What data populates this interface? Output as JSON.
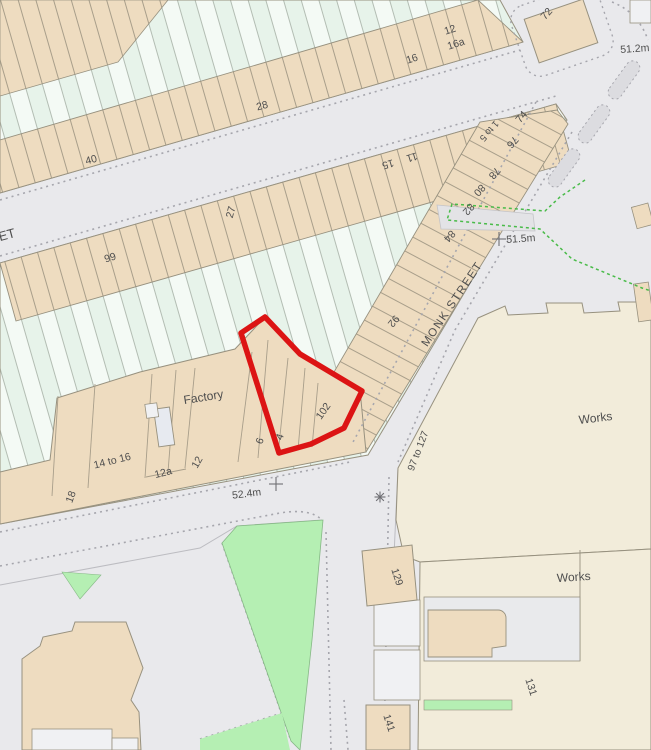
{
  "map": {
    "title": "os-style-plan-with-site-boundary",
    "street_name": "MONK STREET",
    "street_name_partial": "ET",
    "area_labels": [
      "Factory",
      "Works",
      "Works"
    ],
    "spot_heights": [
      "52.4m",
      "51.5m",
      "51.2m"
    ],
    "labels": [
      {
        "t": "ET",
        "x": 8,
        "y": 239,
        "r": -15,
        "s": 13
      },
      {
        "t": "40",
        "x": 92,
        "y": 163,
        "r": -15,
        "s": 10.5
      },
      {
        "t": "28",
        "x": 263,
        "y": 109,
        "r": -15,
        "s": 10.5
      },
      {
        "t": "16",
        "x": 413,
        "y": 62,
        "r": -18,
        "s": 10.5
      },
      {
        "t": "12",
        "x": 451,
        "y": 33,
        "r": -18,
        "s": 10.5
      },
      {
        "t": "16a",
        "x": 457,
        "y": 47,
        "r": -18,
        "s": 10.5
      },
      {
        "t": "72",
        "x": 549,
        "y": 16,
        "r": -48,
        "s": 10.5
      },
      {
        "t": "66",
        "x": 109,
        "y": 254,
        "r": 163,
        "s": 10.5
      },
      {
        "t": "27",
        "x": 234,
        "y": 213,
        "r": -75,
        "s": 10.5
      },
      {
        "t": "15",
        "x": 387,
        "y": 161,
        "r": 163,
        "s": 10.5
      },
      {
        "t": "11",
        "x": 411,
        "y": 154,
        "r": 163,
        "s": 10.5
      },
      {
        "t": "74",
        "x": 524,
        "y": 119,
        "r": -50,
        "s": 10.5
      },
      {
        "t": "1 to 5",
        "x": 487,
        "y": 129,
        "r": 131,
        "s": 9.5
      },
      {
        "t": "76",
        "x": 510,
        "y": 140,
        "r": 131,
        "s": 10.5
      },
      {
        "t": "78",
        "x": 492,
        "y": 171,
        "r": 131,
        "s": 10.5
      },
      {
        "t": "80",
        "x": 477,
        "y": 188,
        "r": 131,
        "s": 10.5
      },
      {
        "t": "82",
        "x": 466,
        "y": 207,
        "r": 131,
        "s": 10.5
      },
      {
        "t": "84",
        "x": 447,
        "y": 234,
        "r": 131,
        "s": 10.5
      },
      {
        "t": "92",
        "x": 391,
        "y": 319,
        "r": 130,
        "s": 10.5
      },
      {
        "t": "102",
        "x": 326,
        "y": 413,
        "r": -55,
        "s": 10.5
      },
      {
        "t": "4",
        "x": 283,
        "y": 438,
        "r": -70,
        "s": 10.5
      },
      {
        "t": "6",
        "x": 263,
        "y": 442,
        "r": -70,
        "s": 10.5
      },
      {
        "t": "12",
        "x": 200,
        "y": 464,
        "r": -60,
        "s": 10.5
      },
      {
        "t": "12a",
        "x": 164,
        "y": 476,
        "r": -14,
        "s": 10.5
      },
      {
        "t": "14 to 16",
        "x": 113,
        "y": 464,
        "r": -14,
        "s": 10.5
      },
      {
        "t": "18",
        "x": 74,
        "y": 498,
        "r": -70,
        "s": 10.5
      },
      {
        "t": "Factory",
        "x": 204,
        "y": 401,
        "r": -9,
        "s": 12
      },
      {
        "t": "52.4m",
        "x": 247,
        "y": 497,
        "r": -7,
        "s": 10.5
      },
      {
        "t": "MONK STREET",
        "x": 455,
        "y": 306,
        "r": -56,
        "s": 11.5,
        "ls": 1.5
      },
      {
        "t": "51.5m",
        "x": 521,
        "y": 242,
        "r": -4,
        "s": 10.5
      },
      {
        "t": "51.2m",
        "x": 635,
        "y": 52,
        "r": -4,
        "s": 10.5
      },
      {
        "t": "97 to 127",
        "x": 421,
        "y": 452,
        "r": -69,
        "s": 10
      },
      {
        "t": "129",
        "x": 394,
        "y": 578,
        "r": 72,
        "s": 10.5
      },
      {
        "t": "131",
        "x": 528,
        "y": 688,
        "r": 72,
        "s": 10.5
      },
      {
        "t": "141",
        "x": 386,
        "y": 724,
        "r": 72,
        "s": 10.5
      },
      {
        "t": "Works",
        "x": 596,
        "y": 422,
        "r": -7,
        "s": 12
      },
      {
        "t": "Works",
        "x": 574,
        "y": 581,
        "r": -4,
        "s": 12
      }
    ],
    "symbols": [
      {
        "type": "level-cross",
        "x": 276,
        "y": 484
      },
      {
        "type": "level-cross",
        "x": 499,
        "y": 239
      },
      {
        "type": "junction-star",
        "x": 380,
        "y": 497
      }
    ],
    "palette": {
      "paved": "#e9e9ec",
      "terrace_beige": "#eedcc0",
      "terrace_green_a": "#e7f3ea",
      "terrace_green_b": "#f4faf5",
      "works_cream": "#f2ecda",
      "green_space": "#b5efb3",
      "outline": "#97917f",
      "strip_line": "#a89e8a",
      "green_line": "#b3bdb3",
      "kerb_dot": "#a6a6ad",
      "kerb_solid": "#bcbcc1",
      "red_boundary": "#dc1414",
      "green_boundary": "#49bb49",
      "structure_gray": "#e7eaf0",
      "court_gray": "#e9eaec",
      "white_block": "#f0f1f3",
      "label_gray": "#4e4e4e"
    }
  }
}
